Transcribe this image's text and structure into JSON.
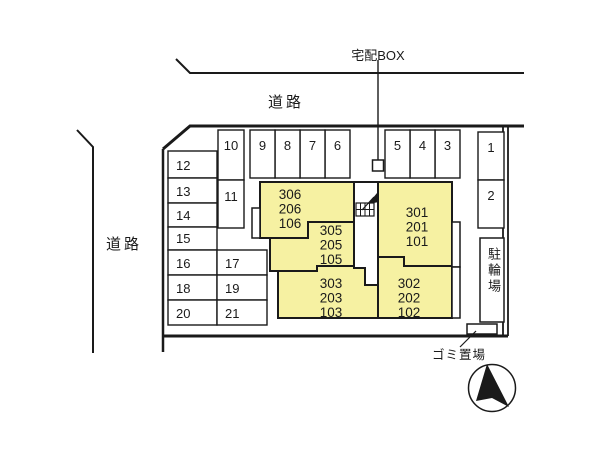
{
  "plan": {
    "road_top_label": "道路",
    "road_left_label": "道路",
    "delivery_box_label": "宅配BOX",
    "bicycle_parking_label": "駐輪場",
    "garbage_area_label": "ゴミ置場"
  },
  "colors": {
    "building_fill": "#F6F1A2",
    "line": "#1A1A1A",
    "background": "#FFFFFF"
  },
  "icons": {
    "stairs_icon": "stairs-with-up-arrow",
    "compass_icon": "north-arrow-in-circle",
    "delivery_box_icon": "small-square-box"
  },
  "parking": {
    "spots": [
      {
        "label": "1"
      },
      {
        "label": "2"
      },
      {
        "label": "3"
      },
      {
        "label": "4"
      },
      {
        "label": "5"
      },
      {
        "label": "6"
      },
      {
        "label": "7"
      },
      {
        "label": "8"
      },
      {
        "label": "9"
      },
      {
        "label": "10"
      },
      {
        "label": "11"
      },
      {
        "label": "12"
      },
      {
        "label": "13"
      },
      {
        "label": "14"
      },
      {
        "label": "15"
      },
      {
        "label": "16"
      },
      {
        "label": "17"
      },
      {
        "label": "18"
      },
      {
        "label": "19"
      },
      {
        "label": "20"
      },
      {
        "label": "21"
      }
    ]
  },
  "building": {
    "units": [
      {
        "lines": [
          "306",
          "206",
          "106"
        ]
      },
      {
        "lines": [
          "305",
          "205",
          "105"
        ]
      },
      {
        "lines": [
          "303",
          "203",
          "103"
        ]
      },
      {
        "lines": [
          "301",
          "201",
          "101"
        ]
      },
      {
        "lines": [
          "302",
          "202",
          "102"
        ]
      }
    ]
  }
}
